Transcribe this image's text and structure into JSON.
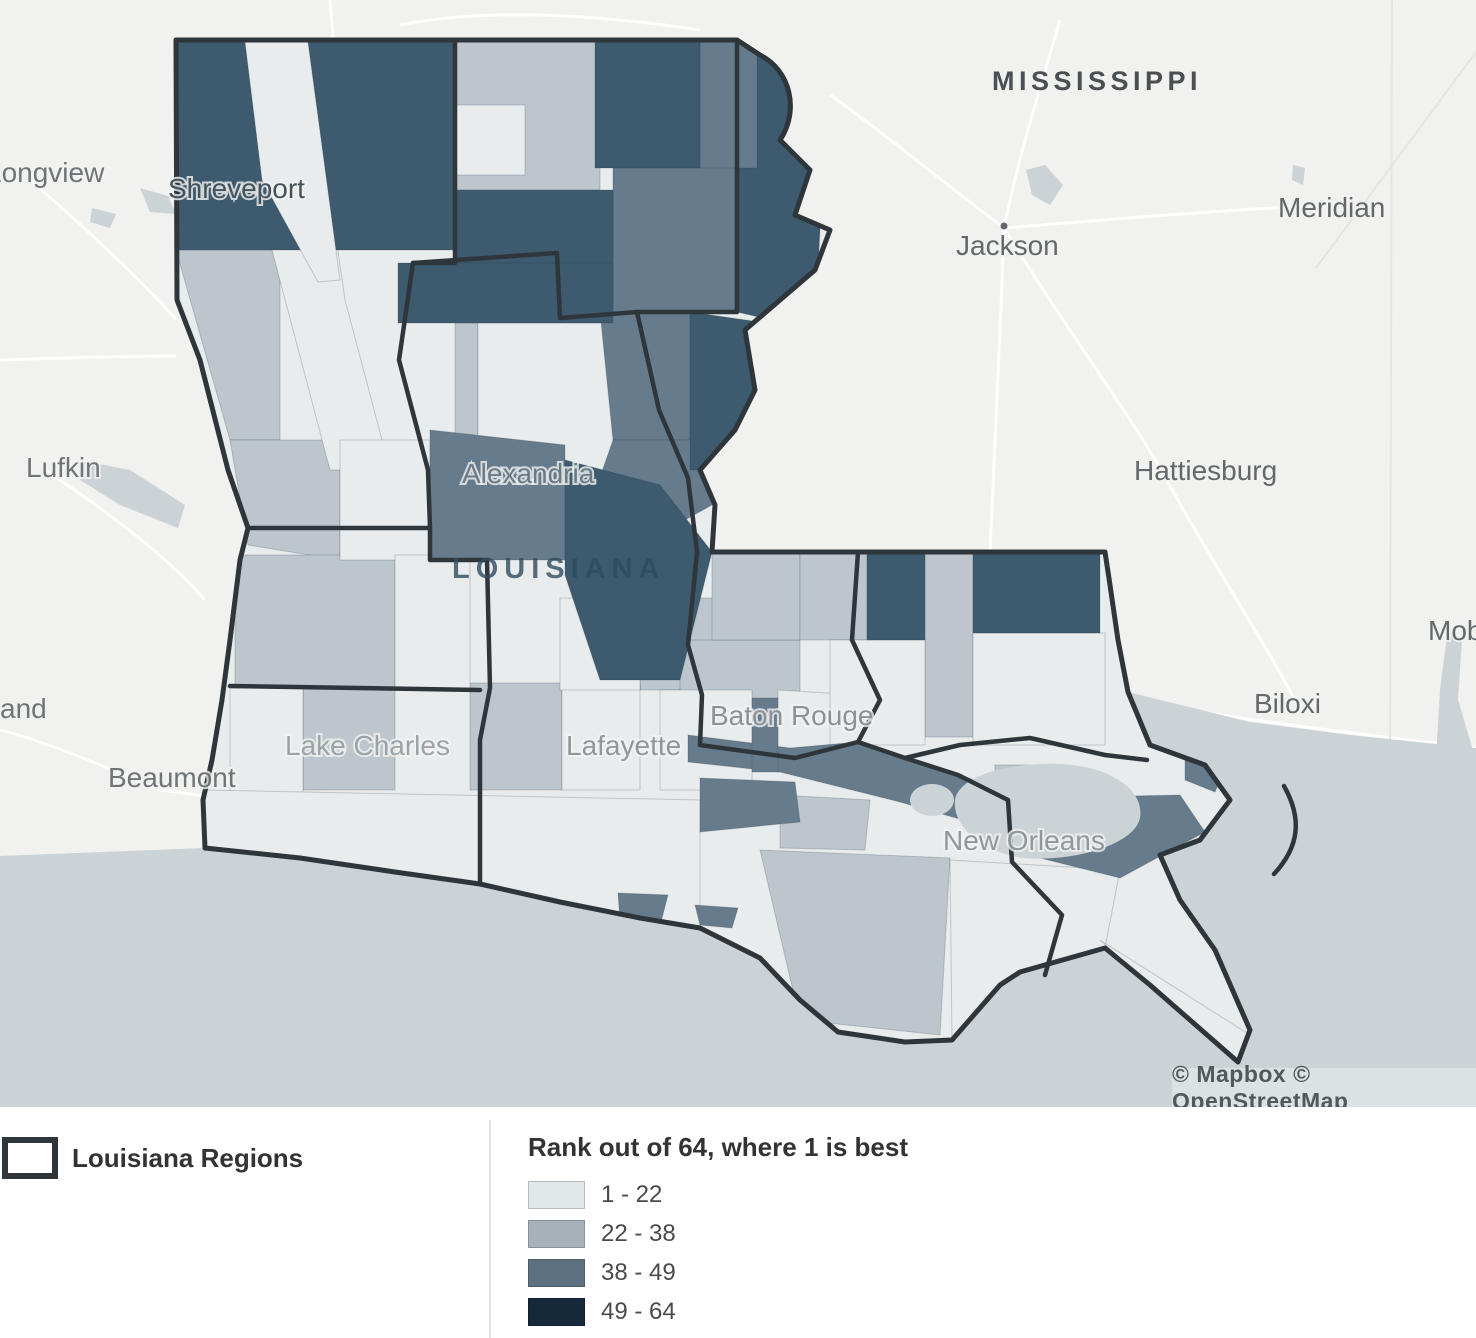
{
  "map": {
    "attribution": "© Mapbox © OpenStreetMap",
    "colors": {
      "land": "#f1f1ef",
      "water": "#cbd3d6",
      "region_border": "#2f363b",
      "class_fills_on_map": [
        "#e9ecec",
        "#bcc6cc",
        "#667b8b",
        "#3d5a6e"
      ]
    },
    "state_labels": [
      {
        "text": "MISSISSIPPI",
        "x": 992,
        "y": 90,
        "size": 27,
        "ls": 4.5,
        "color": "#4a4f53",
        "opacity": 1
      },
      {
        "text": "LOUISIANA",
        "x": 452,
        "y": 578,
        "size": 29,
        "ls": 6,
        "color": "#2e4c5e",
        "opacity": 0.8
      }
    ],
    "city_labels": [
      {
        "text": "Longview",
        "x": -14,
        "y": 182,
        "color": "#6f7477"
      },
      {
        "text": "Shreveport",
        "x": 168,
        "y": 198,
        "color": "#44525c"
      },
      {
        "text": "Lufkin",
        "x": 26,
        "y": 477,
        "color": "#6f7477"
      },
      {
        "text": "and",
        "x": 0,
        "y": 718,
        "color": "#6f7477"
      },
      {
        "text": "Beaumont",
        "x": 108,
        "y": 787,
        "color": "#6f7477"
      },
      {
        "text": "Lake Charles",
        "x": 285,
        "y": 755,
        "color": "#99a3a8"
      },
      {
        "text": "Lafayette",
        "x": 566,
        "y": 755,
        "color": "#8e979c"
      },
      {
        "text": "Alexandria",
        "x": 462,
        "y": 483,
        "color": "#6b7b86"
      },
      {
        "text": "Baton Rouge",
        "x": 710,
        "y": 725,
        "color": "#8a9298"
      },
      {
        "text": "New Orleans",
        "x": 943,
        "y": 850,
        "color": "#8e979c"
      },
      {
        "text": "Jackson",
        "x": 956,
        "y": 255,
        "color": "#63686b",
        "dot": [
          1004,
          226
        ]
      },
      {
        "text": "Meridian",
        "x": 1278,
        "y": 217,
        "color": "#63686b"
      },
      {
        "text": "Hattiesburg",
        "x": 1134,
        "y": 480,
        "color": "#63686b"
      },
      {
        "text": "Biloxi",
        "x": 1254,
        "y": 713,
        "color": "#63686b"
      },
      {
        "text": "Mobile",
        "x": 1428,
        "y": 640,
        "color": "#63686b"
      }
    ]
  },
  "legend": {
    "regions": {
      "label": "Louisiana Regions"
    },
    "rank": {
      "title": "Rank out of 64, where 1 is best",
      "items": [
        {
          "label": "1 - 22",
          "color": "#e1e6e9"
        },
        {
          "label": "22 - 38",
          "color": "#a6b1b9"
        },
        {
          "label": "38 - 49",
          "color": "#5d7181"
        },
        {
          "label": "49 - 64",
          "color": "#15293a"
        }
      ]
    }
  }
}
